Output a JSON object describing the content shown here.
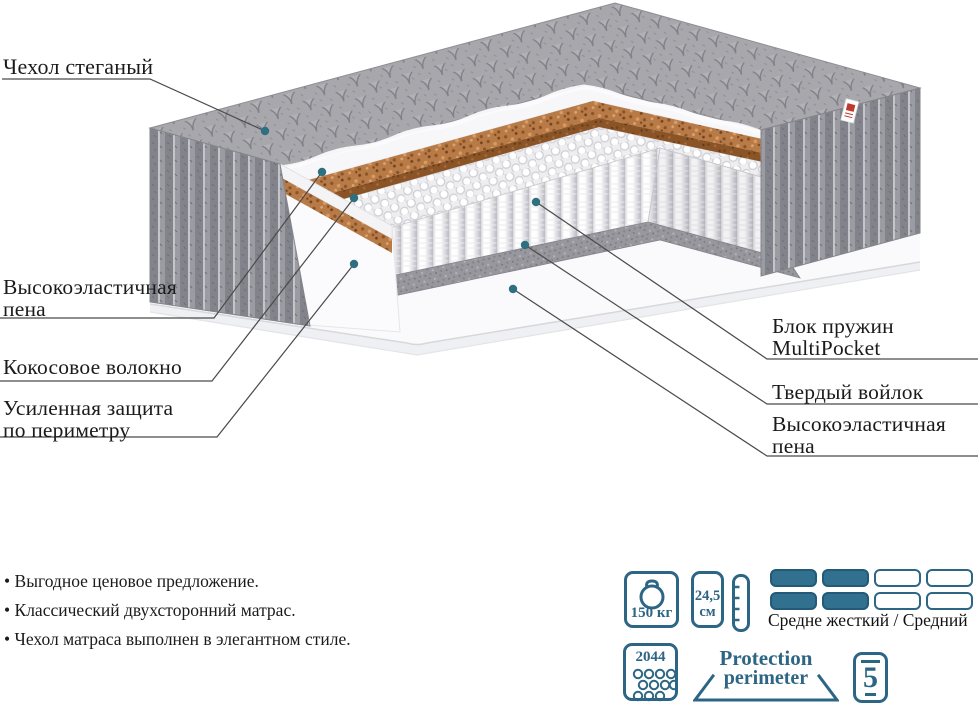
{
  "diagram": {
    "labels": {
      "cover": "Чехол стеганый",
      "foam_left_line1": "Высокоэластичная",
      "foam_left_line2": "пена",
      "coconut": "Кокосовое волокно",
      "perimeter_line1": "Усиленная защита",
      "perimeter_line2": "по периметру",
      "springs_line1": "Блок пружин",
      "springs_line2": "MultiPocket",
      "felt": "Твердый войлок",
      "foam_right_line1": "Высокоэластичная",
      "foam_right_line2": "пена"
    }
  },
  "features": [
    "Выгодное ценовое предложение.",
    "Классический двухсторонний матрас.",
    "Чехол матраса выполнен в элегантном стиле."
  ],
  "specs": {
    "max_weight": "150 кг",
    "height_value": "24,5",
    "height_unit": "см",
    "firmness_label": "Средне жесткий / Средний",
    "springs_count": "2044",
    "protection_line1": "Protection",
    "protection_line2": "perimeter",
    "warranty_years": "5"
  },
  "colors": {
    "accent_blue": "#2d6585",
    "firmness_fill": "#31708f",
    "pointer_dot": "#2e7080",
    "pointer_line": "#4a4a4a",
    "coconut_brown": "#b87a47",
    "quilt_gray": "#a9a9ae",
    "felt_gray": "#97979d"
  }
}
